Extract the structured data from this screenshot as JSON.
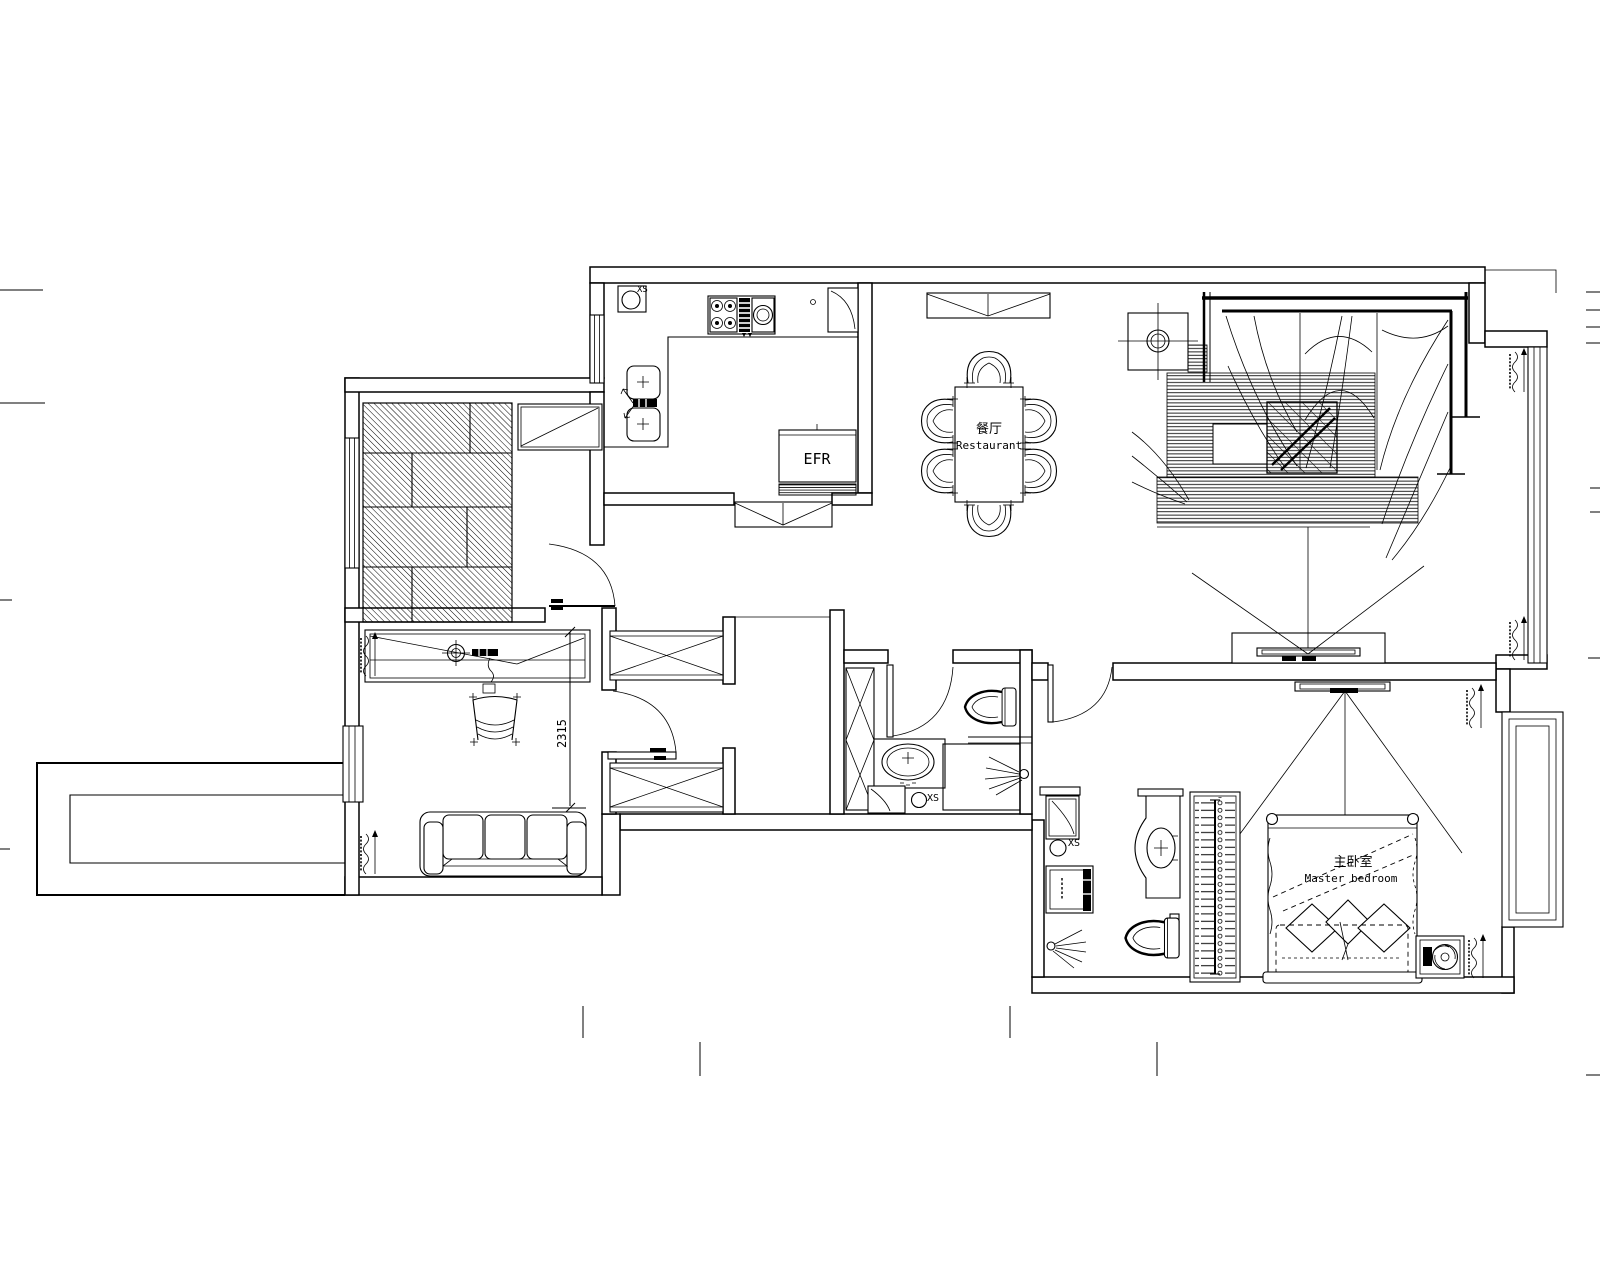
{
  "plan": {
    "type": "residential-floor-plan-cad",
    "background": "#ffffff",
    "line_color": "#000000"
  },
  "texts": {
    "kitchen_xs": "XS",
    "fridge": "EFR",
    "dining_cn": "餐厅",
    "dining_en": "Restaurant",
    "dim": "2315",
    "bath_xs": "XS",
    "master_xs": "XS",
    "master_cn": "主卧室",
    "master_en": "Master bedroom"
  }
}
